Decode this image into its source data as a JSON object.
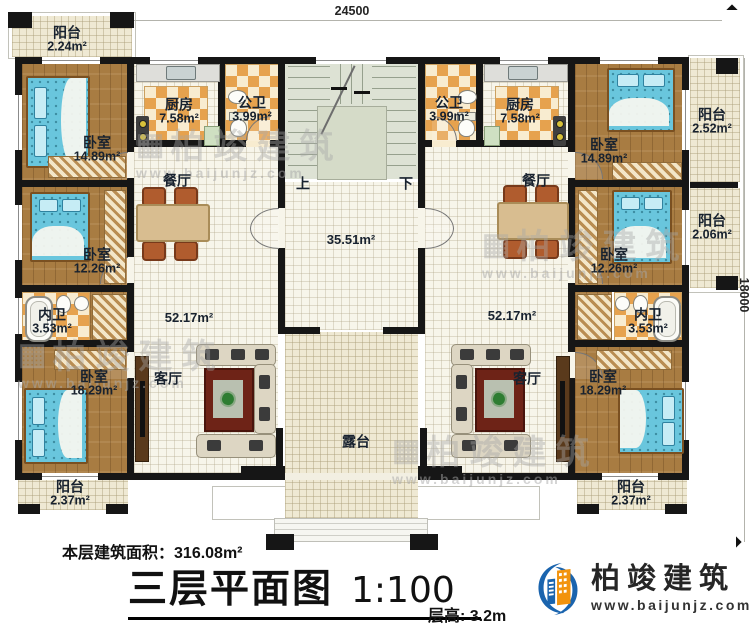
{
  "rooms": {
    "balcony_tl": {
      "name": "阳台",
      "area": "2.24m²"
    },
    "bedroom_tl": {
      "name": "卧室",
      "area": "14.89m²"
    },
    "kitchen_l": {
      "name": "厨房",
      "area": "7.58m²"
    },
    "bath_pub_l": {
      "name": "公卫",
      "area": "3.99m²"
    },
    "bath_pub_r": {
      "name": "公卫",
      "area": "3.99m²"
    },
    "kitchen_r": {
      "name": "厨房",
      "area": "7.58m²"
    },
    "bedroom_tr": {
      "name": "卧室",
      "area": "14.89m²"
    },
    "balcony_tr": {
      "name": "阳台",
      "area": "2.52m²"
    },
    "dining_l": {
      "name": "餐厅"
    },
    "dining_r": {
      "name": "餐厅"
    },
    "bedroom_ml": {
      "name": "卧室",
      "area": "12.26m²"
    },
    "bedroom_mr": {
      "name": "卧室",
      "area": "12.26m²"
    },
    "balcony_mr": {
      "name": "阳台",
      "area": "2.06m²"
    },
    "bath_in_l": {
      "name": "内卫",
      "area": "3.53m²"
    },
    "bath_in_r": {
      "name": "内卫",
      "area": "3.53m²"
    },
    "hall": {
      "area": "35.51m²"
    },
    "living_l": {
      "name": "客厅",
      "area": "52.17m²"
    },
    "living_r": {
      "name": "客厅",
      "area": "52.17m²"
    },
    "stair_up": {
      "name": "上"
    },
    "stair_down": {
      "name": "下"
    },
    "bedroom_bl": {
      "name": "卧室",
      "area": "18.29m²"
    },
    "bedroom_br": {
      "name": "卧室",
      "area": "18.29m²"
    },
    "terrace": {
      "name": "露台"
    },
    "balcony_bl": {
      "name": "阳台",
      "area": "2.37m²"
    },
    "balcony_br": {
      "name": "阳台",
      "area": "2.37m²"
    }
  },
  "dimensions": {
    "width": "24500",
    "height": "18000"
  },
  "footer": {
    "area_label": "本层建筑面积：",
    "area_value": "316.08m²",
    "title": "三层平面图",
    "scale": "1:100",
    "floor_height": "层高: 3.2m"
  },
  "brand": {
    "name": "柏竣建筑",
    "url": "www.baijunjz.com"
  },
  "watermark": {
    "text": "柏竣建筑",
    "url": "www.baijunjz.com"
  }
}
